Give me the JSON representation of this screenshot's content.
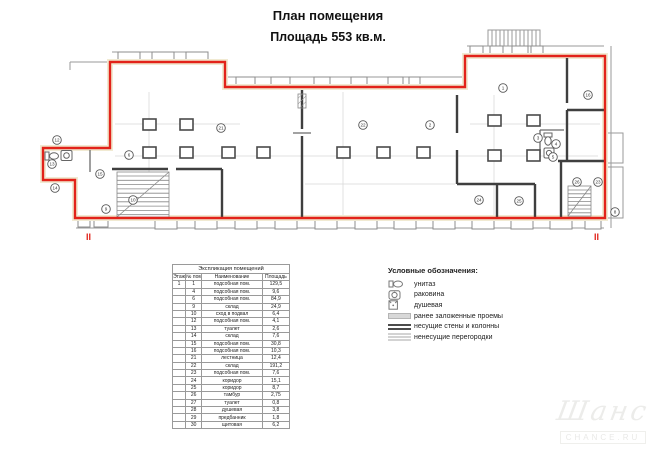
{
  "title": {
    "line1": "План помещения",
    "line2": "Площадь 553 кв.м."
  },
  "plan": {
    "section_marks": [
      "II",
      "II"
    ],
    "rooms": [
      {
        "n": "12",
        "x": 57,
        "y": 140
      },
      {
        "n": "13",
        "x": 52,
        "y": 164
      },
      {
        "n": "14",
        "x": 55,
        "y": 188
      },
      {
        "n": "15",
        "x": 100,
        "y": 174
      },
      {
        "n": "9",
        "x": 106,
        "y": 209
      },
      {
        "n": "10",
        "x": 133,
        "y": 200
      },
      {
        "n": "6",
        "x": 129,
        "y": 155
      },
      {
        "n": "21",
        "x": 221,
        "y": 128
      },
      {
        "n": "22",
        "x": 363,
        "y": 125
      },
      {
        "n": "2",
        "x": 430,
        "y": 125
      },
      {
        "n": "1",
        "x": 503,
        "y": 88
      },
      {
        "n": "16",
        "x": 588,
        "y": 95
      },
      {
        "n": "3",
        "x": 538,
        "y": 138
      },
      {
        "n": "4",
        "x": 556,
        "y": 144
      },
      {
        "n": "5",
        "x": 553,
        "y": 157
      },
      {
        "n": "24",
        "x": 479,
        "y": 200
      },
      {
        "n": "25",
        "x": 519,
        "y": 201
      },
      {
        "n": "26",
        "x": 577,
        "y": 182
      },
      {
        "n": "23",
        "x": 598,
        "y": 182
      },
      {
        "n": "8",
        "x": 615,
        "y": 212
      }
    ],
    "watermark": {
      "script": "Шанс",
      "caption": "CHANCE.RU"
    }
  },
  "table": {
    "title": "Экспликация помещений",
    "headers": [
      "Этаж",
      "№ пом.",
      "Наименование",
      "Площадь"
    ],
    "floor": "1",
    "rows": [
      [
        "1",
        "подсобная пом.",
        "129,5"
      ],
      [
        "4",
        "подсобная пом.",
        "9,6"
      ],
      [
        "6",
        "подсобная пом.",
        "84,9"
      ],
      [
        "9",
        "склад",
        "24,9"
      ],
      [
        "10",
        "сход в подвал",
        "6,4"
      ],
      [
        "12",
        "подсобная пом.",
        "4,1"
      ],
      [
        "13",
        "туалет",
        "2,6"
      ],
      [
        "14",
        "склад",
        "7,6"
      ],
      [
        "15",
        "подсобная пом.",
        "30,8"
      ],
      [
        "16",
        "подсобная пом.",
        "10,3"
      ],
      [
        "21",
        "лестница",
        "12,4"
      ],
      [
        "22",
        "склад",
        "191,2"
      ],
      [
        "23",
        "подсобная пом.",
        "7,6"
      ],
      [
        "24",
        "коридор",
        "15,1"
      ],
      [
        "25",
        "коридор",
        "8,7"
      ],
      [
        "26",
        "тамбур",
        "2,75"
      ],
      [
        "27",
        "туалет",
        "0,8"
      ],
      [
        "28",
        "душевая",
        "3,8"
      ],
      [
        "29",
        "предбанник",
        "1,8"
      ],
      [
        "30",
        "щитовая",
        "6,2"
      ]
    ]
  },
  "legend": {
    "title": "Условные обозначения:",
    "items": [
      {
        "icon": "toilet-icon",
        "label": "унитаз"
      },
      {
        "icon": "sink-icon",
        "label": "раковина"
      },
      {
        "icon": "shower-icon",
        "label": "душевая"
      },
      {
        "icon": "filled-opening-icon",
        "label": "ранее заложенные проемы"
      },
      {
        "icon": "bearing-wall-icon",
        "label": "несущие стены и колонны"
      },
      {
        "icon": "partition-icon",
        "label": "ненесущие перегородки"
      }
    ]
  },
  "colors": {
    "outline_red": "#e2231a",
    "bearing_wall": "#3f3f3f",
    "partition_gray": "#b9b9b9",
    "wall_band_tan": "#f1ead2"
  }
}
